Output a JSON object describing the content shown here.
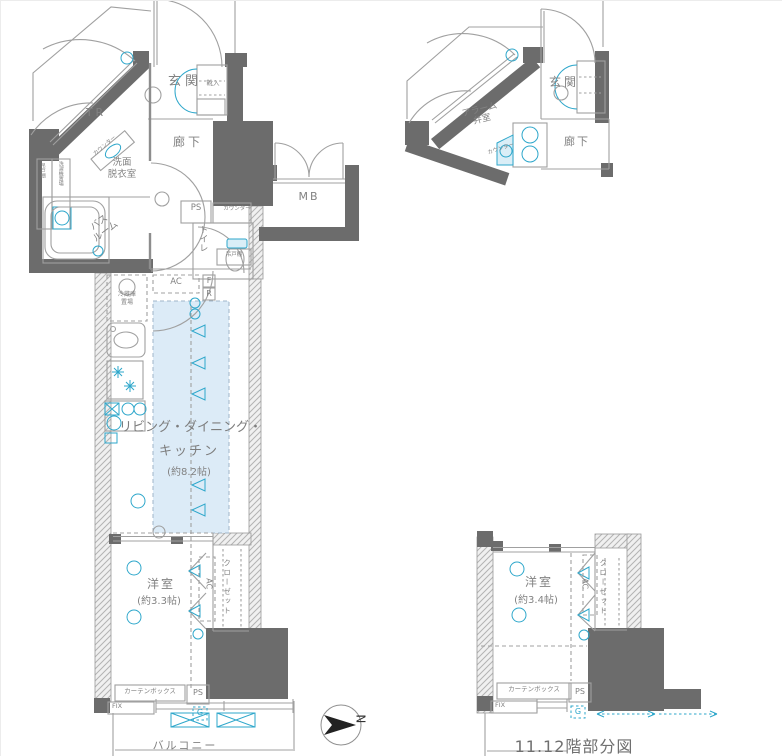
{
  "caption": "11.12階部分図",
  "compass": {
    "north": "N"
  },
  "colors": {
    "wall": "#6c6c6c",
    "line": "#a0a0a0",
    "text": "#828282",
    "accent": "#2ea7cb",
    "accent_light": "#daeef7",
    "ldk_fill": "#dcebf7"
  },
  "main_plan": {
    "trunk_room": "TR",
    "entrance": "玄関",
    "shoe_cabinet": "靴入",
    "hallway": "廊下",
    "washroom_line1": "洗面",
    "washroom_line2": "脱衣室",
    "bathroom_line1": "バス",
    "bathroom_line2": "ルーム",
    "toilet": "トイレ",
    "pipe_space_top": "PS",
    "counter_top": "カウンター",
    "hanging_cupboard_toilet": "吊戸棚",
    "hanging_cupboard_washroom": "吊戸棚",
    "washer_space": "洗濯機置場",
    "counter_washroom": "カウンター",
    "meter_box": "MB",
    "fridge_line1": "冷蔵庫",
    "fridge_line2": "置場",
    "ac": "AC",
    "alarm_f": "F",
    "alarm_r": "R",
    "ldk_line1": "リビング・ダイニング・",
    "ldk_line2": "キッチン",
    "ldk_size": "(約8.2帖)",
    "western_room": "洋室",
    "western_room_size": "(約3.3帖)",
    "closet": "クローゼット",
    "closet_ac": "AC",
    "curtain_box": "カーテンボックス",
    "pipe_space_bottom": "PS",
    "fix_window": "FIX",
    "gas": "G",
    "balcony": "バルコニー"
  },
  "upper_partial": {
    "alarm_line1": "アラーム",
    "alarm_line2": "弁室",
    "entrance": "玄関",
    "hallway": "廊下",
    "counter": "カウンター"
  },
  "lower_partial": {
    "western_room": "洋室",
    "western_room_size": "(約3.4帖)",
    "closet": "クローゼット",
    "closet_ac": "AC",
    "curtain_box": "カーテンボックス",
    "pipe_space": "PS",
    "fix_window": "FIX",
    "gas": "G"
  }
}
